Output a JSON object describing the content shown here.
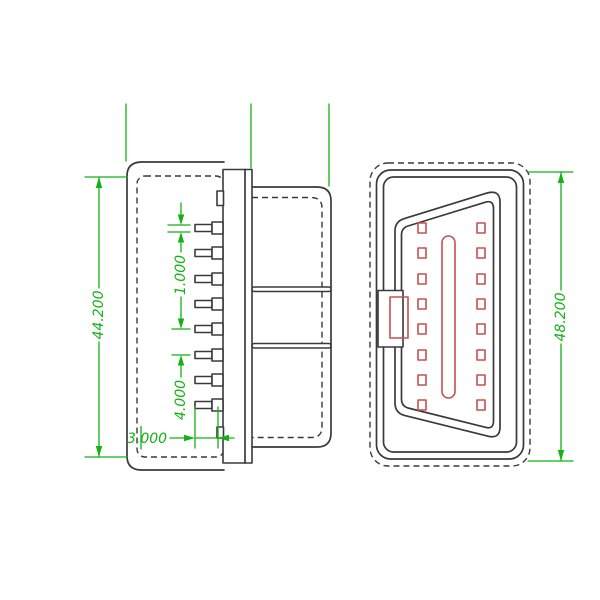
{
  "drawing": {
    "colors": {
      "background": "#ffffff",
      "outline": "#3a3a3a",
      "dimension_green": "#12b212",
      "contact_red": "#c65050"
    },
    "dimensions": {
      "body_height": "44.200",
      "pin_thickness": "1.000",
      "pin_pitch": "4.000",
      "pin_length": "3.000",
      "face_height": "48.200"
    },
    "side_view_pin_count": 8,
    "front_view_contact_count": 16
  }
}
